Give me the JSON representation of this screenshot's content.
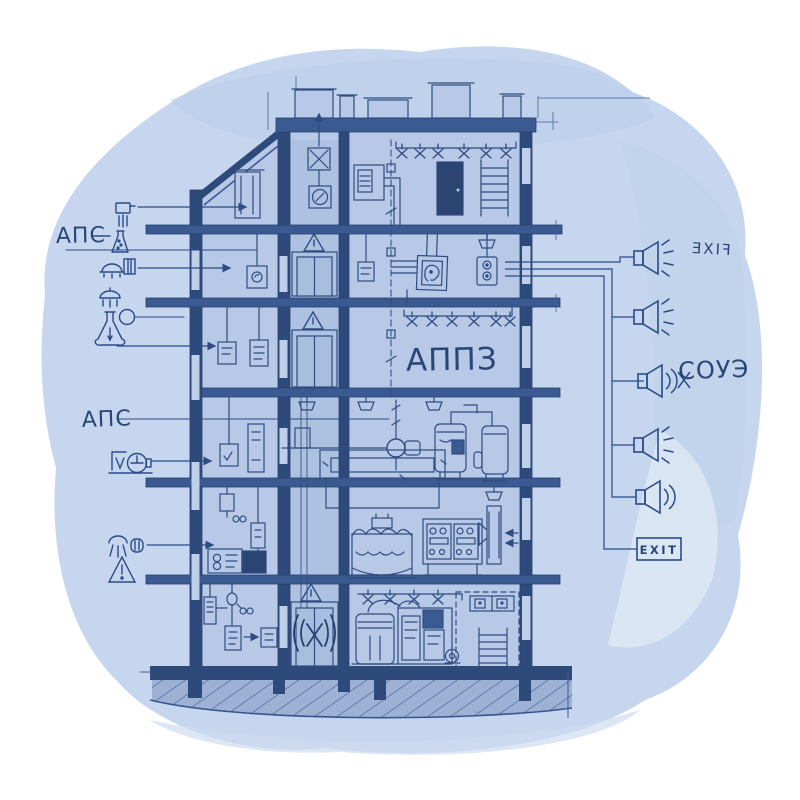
{
  "artwork": {
    "kind": "hand-drawn blueprint illustration",
    "subject": "building cross-section with automatic fire protection systems"
  },
  "palette": {
    "paper": "#ffffff",
    "wash": "#c6d6ee",
    "wash_deep": "#b9cde9",
    "room": "#b7c9e6",
    "core": "#adc2e1",
    "wall": "#2e4a7b",
    "slab": "#3c5a92",
    "ink": "#2f4c80",
    "dark_fill": "#2b4472",
    "ground": "#9cb1d3",
    "text_ink": "#2a4577"
  },
  "labels": {
    "aps_upper": "АПС",
    "aps_lower": "АПС",
    "appz": "АППЗ",
    "souz": "СОУЭ",
    "exit_mirrored": "FIXE",
    "exit_sign": "EXIT"
  },
  "legend_left": {
    "items": [
      {
        "icon": "manual-call-point-icon"
      },
      {
        "icon": "heat-detector-flask-icon",
        "label": "АПС"
      },
      {
        "icon": "smoke-detector-icon"
      },
      {
        "icon": "hood-detector-icon"
      },
      {
        "icon": "flask-and-gauge-icon"
      },
      {
        "icon": "valve-actuator-icon",
        "label": "АПС"
      },
      {
        "icon": "sprinkler-spray-icon"
      },
      {
        "icon": "warning-triangle-icon"
      }
    ]
  },
  "right_column": {
    "speakers": [
      {
        "icon": "horn-speaker-rays-icon"
      },
      {
        "icon": "horn-speaker-rays-icon"
      },
      {
        "icon": "horn-speaker-waves-x-icon"
      },
      {
        "icon": "horn-speaker-rays-icon"
      },
      {
        "icon": "horn-speaker-waves-icon"
      }
    ]
  },
  "building": {
    "floors_visible": 6,
    "features": [
      "roof-vents",
      "sprinkler-lines",
      "elevator-shaft",
      "appz-room",
      "pressure-tanks",
      "control-panel",
      "wavy-tank",
      "basement-pump-room",
      "ladders",
      "ground-hatch"
    ]
  }
}
